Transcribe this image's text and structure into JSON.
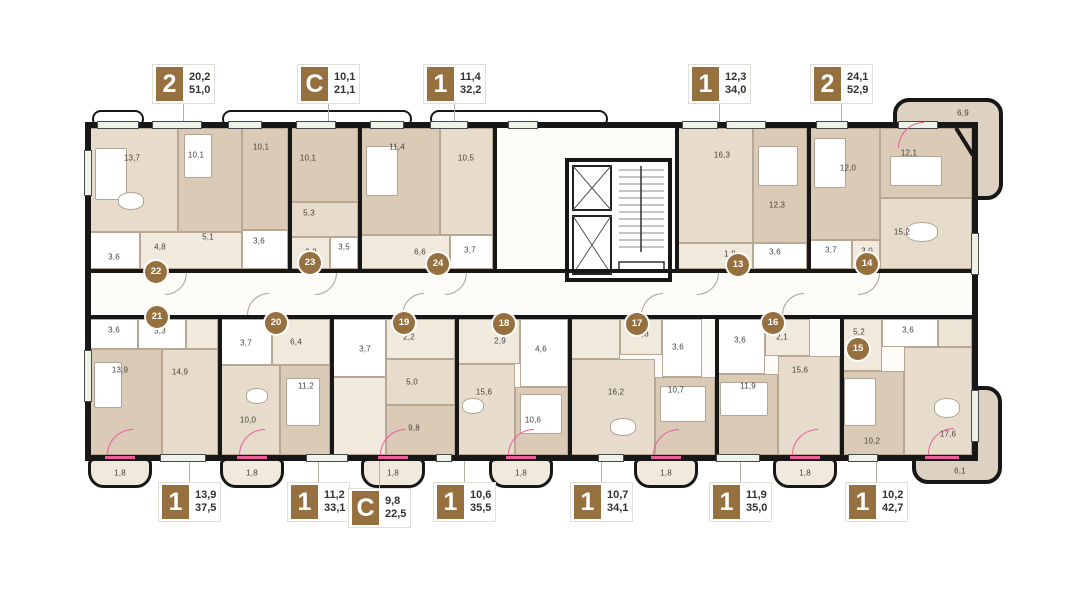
{
  "colors": {
    "badge": "#96703f",
    "wall": "#171717",
    "pink": "#ec5c9e",
    "window": "#eef3e7",
    "room_dark": "#dbcbb6",
    "room_mid": "#e7dccb",
    "room_light": "#f0e9dc",
    "bath": "#ffffff",
    "balcony": "#ddd2c2"
  },
  "callouts_top": [
    {
      "type": "2",
      "living": "20,2",
      "total": "51,0",
      "x": 152,
      "leader_h": 96
    },
    {
      "type": "С",
      "living": "10,1",
      "total": "21,1",
      "x": 297,
      "leader_h": 58
    },
    {
      "type": "1",
      "living": "11,4",
      "total": "32,2",
      "x": 423,
      "leader_h": 96
    },
    {
      "type": "1",
      "living": "12,3",
      "total": "34,0",
      "x": 688,
      "leader_h": 94
    },
    {
      "type": "2",
      "living": "24,1",
      "total": "52,9",
      "x": 810,
      "leader_h": 56
    }
  ],
  "callouts_bottom": [
    {
      "type": "1",
      "living": "13,9",
      "total": "37,5",
      "x": 158,
      "dy": 0
    },
    {
      "type": "1",
      "living": "11,2",
      "total": "33,1",
      "x": 287,
      "dy": 0
    },
    {
      "type": "С",
      "living": "9,8",
      "total": "22,5",
      "x": 348,
      "dy": 6
    },
    {
      "type": "1",
      "living": "10,6",
      "total": "35,5",
      "x": 433,
      "dy": 0
    },
    {
      "type": "1",
      "living": "10,7",
      "total": "34,1",
      "x": 570,
      "dy": 0
    },
    {
      "type": "1",
      "living": "11,9",
      "total": "35,0",
      "x": 709,
      "dy": 0
    },
    {
      "type": "1",
      "living": "10,2",
      "total": "42,7",
      "x": 845,
      "dy": 0
    }
  ],
  "unit_badges": [
    {
      "n": "13",
      "x": 738,
      "y": 265
    },
    {
      "n": "14",
      "x": 867,
      "y": 264
    },
    {
      "n": "15",
      "x": 858,
      "y": 349
    },
    {
      "n": "16",
      "x": 773,
      "y": 323
    },
    {
      "n": "17",
      "x": 637,
      "y": 324
    },
    {
      "n": "18",
      "x": 504,
      "y": 324
    },
    {
      "n": "19",
      "x": 404,
      "y": 323
    },
    {
      "n": "20",
      "x": 276,
      "y": 323
    },
    {
      "n": "21",
      "x": 157,
      "y": 317
    },
    {
      "n": "22",
      "x": 156,
      "y": 272
    },
    {
      "n": "23",
      "x": 310,
      "y": 263
    },
    {
      "n": "24",
      "x": 438,
      "y": 264
    }
  ],
  "room_labels": [
    {
      "t": "13,7",
      "x": 132,
      "y": 158
    },
    {
      "t": "10,1",
      "x": 196,
      "y": 155
    },
    {
      "t": "10,1",
      "x": 261,
      "y": 147
    },
    {
      "t": "3,6",
      "x": 259,
      "y": 241
    },
    {
      "t": "3,6",
      "x": 114,
      "y": 257
    },
    {
      "t": "4,8",
      "x": 160,
      "y": 247
    },
    {
      "t": "5,1",
      "x": 208,
      "y": 237
    },
    {
      "t": "10,1",
      "x": 308,
      "y": 158
    },
    {
      "t": "5,3",
      "x": 309,
      "y": 213
    },
    {
      "t": "2,2",
      "x": 311,
      "y": 252
    },
    {
      "t": "3,5",
      "x": 344,
      "y": 247
    },
    {
      "t": "11,4",
      "x": 397,
      "y": 147
    },
    {
      "t": "10,5",
      "x": 466,
      "y": 158
    },
    {
      "t": "6,6",
      "x": 420,
      "y": 252
    },
    {
      "t": "3,7",
      "x": 470,
      "y": 250
    },
    {
      "t": "16,3",
      "x": 722,
      "y": 155
    },
    {
      "t": "12,3",
      "x": 777,
      "y": 205
    },
    {
      "t": "1,8",
      "x": 730,
      "y": 254
    },
    {
      "t": "3,6",
      "x": 775,
      "y": 252
    },
    {
      "t": "12,0",
      "x": 848,
      "y": 168
    },
    {
      "t": "12,1",
      "x": 909,
      "y": 153
    },
    {
      "t": "15,2",
      "x": 902,
      "y": 232
    },
    {
      "t": "3,7",
      "x": 831,
      "y": 250
    },
    {
      "t": "3,0",
      "x": 867,
      "y": 251
    },
    {
      "t": "6,9",
      "x": 963,
      "y": 113
    },
    {
      "t": "3,6",
      "x": 114,
      "y": 330
    },
    {
      "t": "3,3",
      "x": 160,
      "y": 331
    },
    {
      "t": "13,9",
      "x": 120,
      "y": 370
    },
    {
      "t": "14,9",
      "x": 180,
      "y": 372
    },
    {
      "t": "1,8",
      "x": 120,
      "y": 473
    },
    {
      "t": "3,7",
      "x": 246,
      "y": 343
    },
    {
      "t": "6,4",
      "x": 296,
      "y": 342
    },
    {
      "t": "10,0",
      "x": 248,
      "y": 420
    },
    {
      "t": "11,2",
      "x": 306,
      "y": 386
    },
    {
      "t": "1,8",
      "x": 252,
      "y": 473
    },
    {
      "t": "2,2",
      "x": 409,
      "y": 337
    },
    {
      "t": "3,7",
      "x": 365,
      "y": 349
    },
    {
      "t": "5,0",
      "x": 412,
      "y": 382
    },
    {
      "t": "9,8",
      "x": 414,
      "y": 428
    },
    {
      "t": "1,8",
      "x": 393,
      "y": 473
    },
    {
      "t": "2,9",
      "x": 500,
      "y": 341
    },
    {
      "t": "4,6",
      "x": 541,
      "y": 349
    },
    {
      "t": "15,6",
      "x": 484,
      "y": 392
    },
    {
      "t": "10,6",
      "x": 533,
      "y": 420
    },
    {
      "t": "1,8",
      "x": 521,
      "y": 473
    },
    {
      "t": "1,8",
      "x": 643,
      "y": 334
    },
    {
      "t": "3,6",
      "x": 678,
      "y": 347
    },
    {
      "t": "16,2",
      "x": 616,
      "y": 392
    },
    {
      "t": "10,7",
      "x": 676,
      "y": 390
    },
    {
      "t": "1,8",
      "x": 666,
      "y": 473
    },
    {
      "t": "3,6",
      "x": 740,
      "y": 340
    },
    {
      "t": "2,1",
      "x": 782,
      "y": 337
    },
    {
      "t": "11,9",
      "x": 748,
      "y": 386
    },
    {
      "t": "15,6",
      "x": 800,
      "y": 370
    },
    {
      "t": "1,8",
      "x": 805,
      "y": 473
    },
    {
      "t": "5,2",
      "x": 859,
      "y": 332
    },
    {
      "t": "3,6",
      "x": 908,
      "y": 330
    },
    {
      "t": "10,2",
      "x": 872,
      "y": 441
    },
    {
      "t": "17,6",
      "x": 948,
      "y": 434
    },
    {
      "t": "6,1",
      "x": 960,
      "y": 471
    }
  ]
}
